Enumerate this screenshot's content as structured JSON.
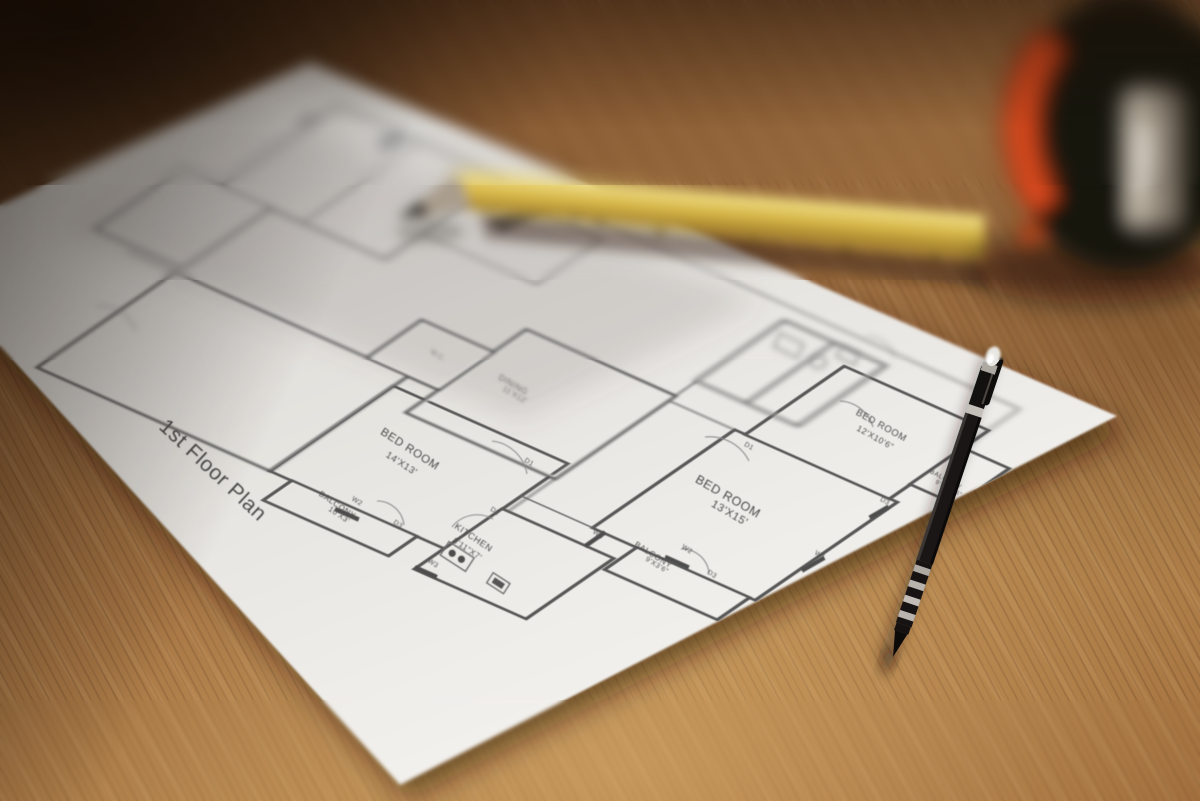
{
  "photo": {
    "subject": "1st floor architectural plan printed on white paper, lying on a wooden table",
    "objects": [
      "white floor-plan sheet",
      "black mechanical pencil",
      "yellow carpenter pencil",
      "black tape measure with orange stripe",
      "wooden table surface"
    ]
  },
  "floor_plan": {
    "title": "1st Floor Plan",
    "rooms": {
      "bedroom_a": {
        "name": "BED ROOM",
        "dims": "14'X13'"
      },
      "bedroom_b": {
        "name": "BED ROOM",
        "dims": "13'X15'"
      },
      "bedroom_c": {
        "name": "BED ROOM",
        "dims": "12'X10'6\""
      },
      "kitchen": {
        "name": "KITCHEN",
        "dims": "8'11\"X7'"
      },
      "dining": {
        "name": "DINING",
        "dims": "11'X12'"
      },
      "balcony_a": {
        "name": "BALCONY",
        "dims": "10'X3'"
      },
      "balcony_b": {
        "name": "BALCONY",
        "dims": "9'X3'6\""
      },
      "balcony_c": {
        "name": "BALCONY",
        "dims": "9'5\"X3'6\""
      },
      "wc": {
        "name": "W.C.",
        "dims": ""
      }
    },
    "markers": {
      "w1": "W1",
      "w2": "W2",
      "w3": "W3",
      "d1": "D1",
      "d2": "D2",
      "d3": "D3"
    }
  },
  "colors": {
    "wood_mid": "#a67544",
    "wood_dark": "#2a180b",
    "wood_light": "#c59a64",
    "paper": "#efede9",
    "print_ink": "#4b4b4b",
    "pen_body": "#17120f",
    "pen_chrome": "#d9d5cf",
    "pencil_yellow": "#d8b84a",
    "tape_body": "#171310",
    "tape_accent": "#d8491c",
    "tape_clip": "#b7ac9c"
  }
}
